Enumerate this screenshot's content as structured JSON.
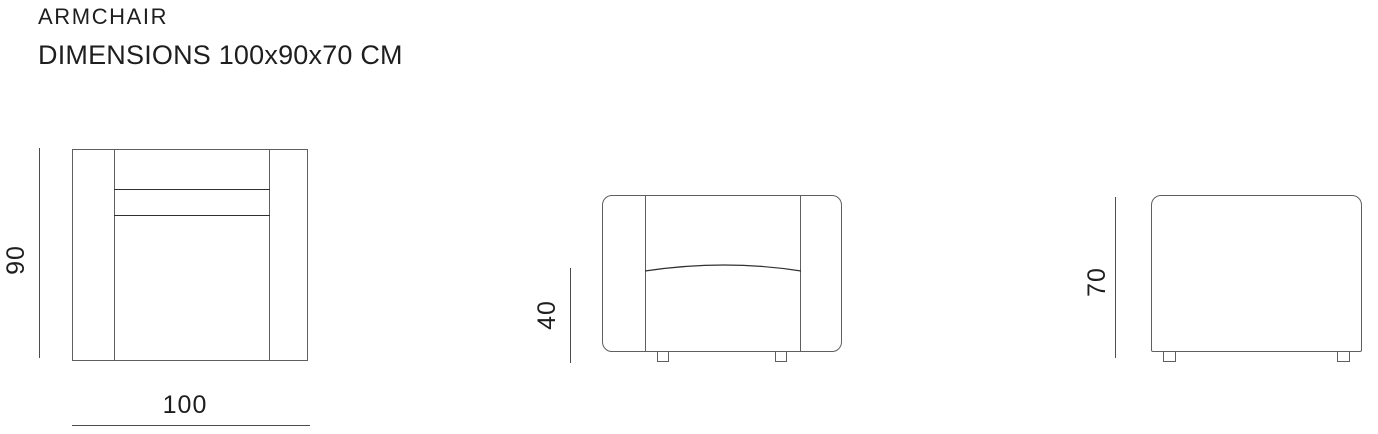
{
  "header": {
    "title": "ARMCHAIR",
    "subtitle": "DIMENSIONS 100x90x70 CM"
  },
  "views": {
    "top": {
      "label_depth": "90",
      "label_width": "100"
    },
    "front": {
      "label_seat_height": "40"
    },
    "side": {
      "label_height": "70"
    }
  },
  "colors": {
    "background": "#ffffff",
    "text": "#1e1e1e",
    "outline_line": "#5f5f5f",
    "detail_line": "#303030",
    "dimension_line": "#4c4c4c"
  }
}
